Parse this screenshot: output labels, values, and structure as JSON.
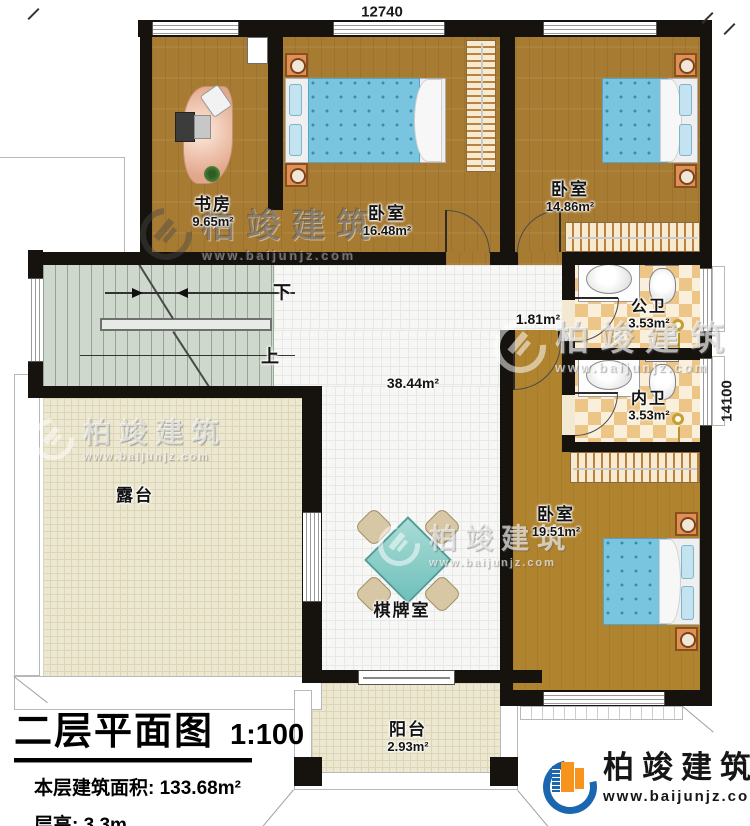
{
  "plan": {
    "dim_top": "12740",
    "dim_right": "14100"
  },
  "rooms": {
    "study": {
      "label": "书房",
      "area": "9.65m²"
    },
    "bedroom1": {
      "label": "卧室",
      "area": "16.48m²"
    },
    "bedroom2": {
      "label": "卧室",
      "area": "14.86m²"
    },
    "public_bath": {
      "label": "公卫",
      "area": "3.53m²"
    },
    "private_bath": {
      "label": "内卫",
      "area": "3.53m²"
    },
    "bedroom3": {
      "label": "卧室",
      "area": "19.51m²"
    },
    "terrace": {
      "label": "露台"
    },
    "chess_room": {
      "label": "棋牌室"
    },
    "balcony": {
      "label": "阳台",
      "area": "2.93m²"
    },
    "hall": {
      "area": "38.44m²"
    },
    "hall_nook": {
      "area": "1.81m²"
    }
  },
  "stairs": {
    "down_label": "下",
    "up_label": "上"
  },
  "titleblock": {
    "title": "二层平面图",
    "scale": "1:100",
    "area_line": "本层建筑面积: 133.68m²",
    "height_line": "层高: 3.3m"
  },
  "watermark": {
    "name": "柏竣建筑",
    "url": "www.baijunjz.com"
  },
  "brand": {
    "name": "柏竣建筑",
    "url": "www.baijunjz.com"
  },
  "colors": {
    "wall": "#16130f",
    "wood": "#a87b33",
    "tile": "#f7f7f6",
    "stair": "#cfd8cc",
    "terrace": "#ebe7d0",
    "bath_tile": "#ecc587",
    "bed_blue": "#79c4de",
    "brand_blue": "#1a67b0",
    "brand_orange": "#f7941d"
  }
}
